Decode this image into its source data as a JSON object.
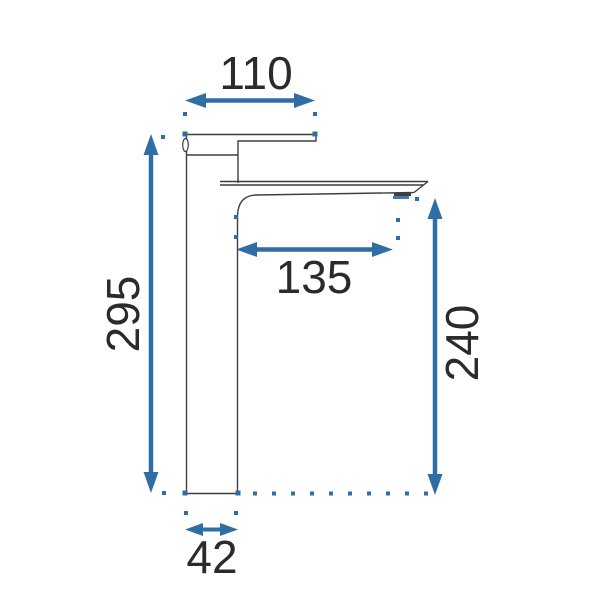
{
  "colors": {
    "accent": "#2f6ea5",
    "line": "#3f3f3f",
    "text": "#2b2b2b",
    "background": "#ffffff"
  },
  "diagram": {
    "type": "technical-dimension-drawing",
    "subject": "tall single-lever basin faucet, side view",
    "units": "mm",
    "dimensions": {
      "spout_top_width": {
        "value": "110",
        "orientation": "horizontal",
        "position": "top"
      },
      "total_height": {
        "value": "295",
        "orientation": "vertical",
        "position": "left"
      },
      "spout_reach": {
        "value": "135",
        "orientation": "horizontal",
        "position": "middle"
      },
      "outlet_height": {
        "value": "240",
        "orientation": "vertical",
        "position": "right"
      },
      "base_width": {
        "value": "42",
        "orientation": "horizontal",
        "position": "bottom"
      }
    }
  }
}
